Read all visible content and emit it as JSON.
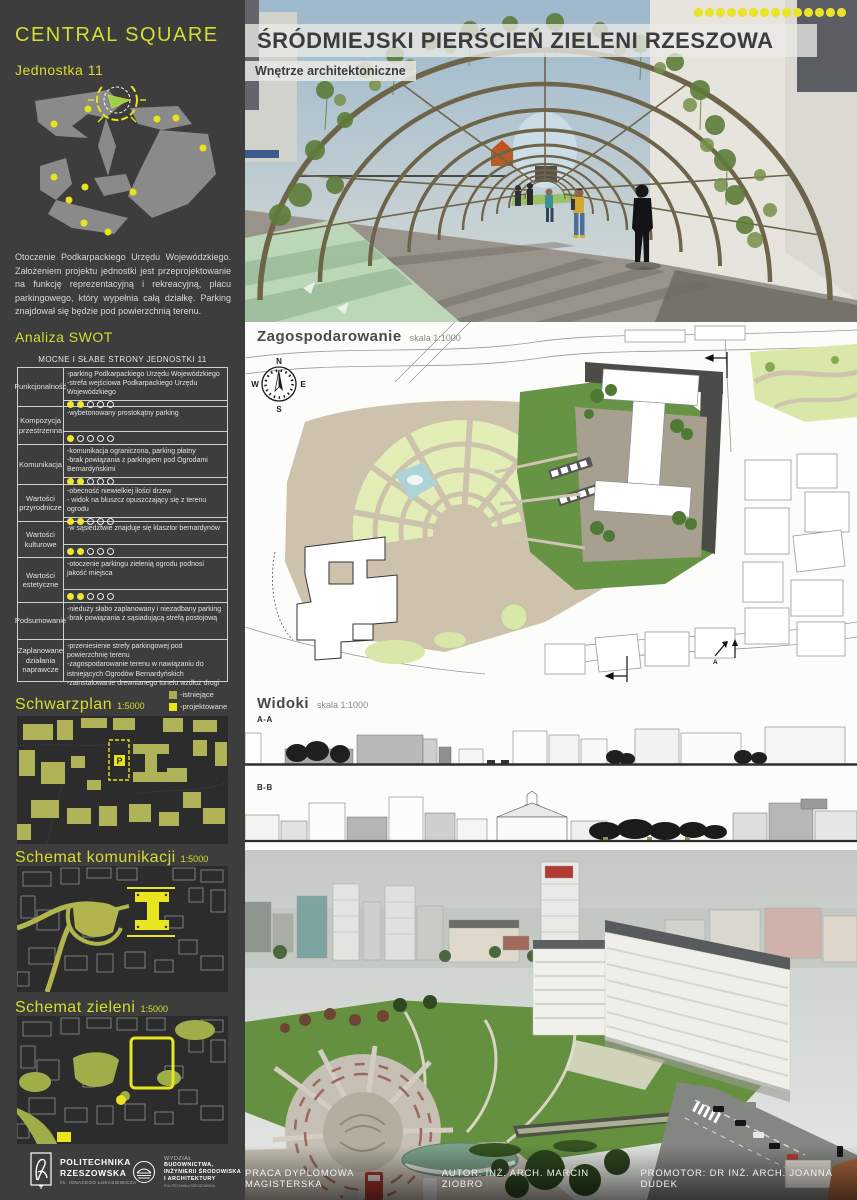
{
  "sidebar": {
    "title": "CENTRAL SQUARE",
    "unit_label": "Jednostka 11",
    "description": "Otoczenie Podkarpackiego Urzędu Wojewódzkiego. Założeniem projektu jednostki jest przeprojektowanie na funkcję reprezentacyjną i rekreacyjną, placu parkingowego, który wypełnia całą działkę. Parking znajdował się  będzie pod powierzchnią terenu.",
    "swot": {
      "heading": "Analiza SWOT",
      "table_header": "MOCNE I SŁABE STRONY JEDNOSTKI 11",
      "rating_max": 5,
      "rows": [
        {
          "category": "Funkcjonalność",
          "items": "-parking Podkarpackiego Urzędu Wojewódzkiego\n-strefa wejściowa Podkarpackiego Urzędu Wojewódzkiego",
          "rating": 2
        },
        {
          "category": "Kompozycja przestrzenna",
          "items": "-wybetonowany prostokątny parking",
          "rating": 1
        },
        {
          "category": "Komunikacja",
          "items": "-komunikacja ograniczona, parking płatny\n-brak powiązania z parkingiem pod Ogrodami Bernardyńskimi",
          "rating": 2
        },
        {
          "category": "Wartości przyrodnicze",
          "items": "-obecność niewielkiej ilości drzew\n- widok na bluszcz opuszczający się z terenu ogrodu",
          "rating": 2
        },
        {
          "category": "Wartości kulturowe",
          "items": "-w sąsiedztwie znajduje się klasztor bernardynów",
          "rating": 2
        },
        {
          "category": "Wartości estetyczne",
          "items": "-otoczenie parkingu zielenią ogrodu podnosi jakość miejsca",
          "rating": 2
        },
        {
          "category": "Podsumowanie",
          "items": "-nieduży słabo zaplanowany i niezadbany parking\n-brak powiązania z sąsiadującą strefą postojową",
          "rating": null
        },
        {
          "category": "Zaplanowane działania naprawcze",
          "items": "-przeniesienie strefy parkingowej pod powierzchnię terenu\n-zagospodarowanie terenu w nawiązaniu do istniejących Ogrodów Bernardyńskich\n-zainstalowanie drewnianego tunelu wzdłuż drogi",
          "rating": null
        }
      ]
    },
    "legend": {
      "existing": "-istniejące",
      "projected": "-projektowane"
    },
    "maps": [
      {
        "title": "Schwarzplan",
        "scale": "1:5000",
        "marker": "P"
      },
      {
        "title": "Schemat komunikacji",
        "scale": "1:5000"
      },
      {
        "title": "Schemat zieleni",
        "scale": "1:5000"
      }
    ],
    "logos": {
      "politechnika": {
        "line1": "POLITECHNIKA",
        "line2": "RZESZOWSKA",
        "subtitle": "im. IGNACEGO ŁUKASIEWICZA"
      },
      "wydzial": {
        "line1": "WYDZIAŁ",
        "line2": "BUDOWNICTWA,",
        "line3": "INŻYNIERII ŚRODOWISKA",
        "line4": "I ARCHITEKTURY",
        "subtitle": "POLITECHNIKA RZESZOWSKA"
      }
    }
  },
  "main": {
    "title": "ŚRÓDMIEJSKI PIERŚCIEŃ ZIELENI RZESZOWA",
    "subtitle": "Wnętrze architektoniczne",
    "dots_count": 14,
    "plan": {
      "title": "Zagospodarowanie",
      "scale": "skala 1:1000",
      "marker_a": "A",
      "compass": {
        "n": "N",
        "e": "E",
        "s": "S",
        "w": "W"
      }
    },
    "views": {
      "title": "Widoki",
      "scale": "skala 1:1000",
      "section_a": "A-A",
      "section_b": "B-B"
    },
    "footer": {
      "part1": "PRACA DYPLOMOWA MAGISTERSKA",
      "part2": "AUTOR: INŻ. ARCH. MARCIN ZIOBRO",
      "part3": "PROMOTOR: DR INŻ. ARCH. JOANNA DUDEK"
    }
  },
  "colors": {
    "accent_yellow": "#d7dd2e",
    "dot_yellow": "#e9e32a",
    "legend_existing": "#a9ac55",
    "legend_projected": "#e9e416",
    "sidebar_bg": "#3d3d3d"
  }
}
